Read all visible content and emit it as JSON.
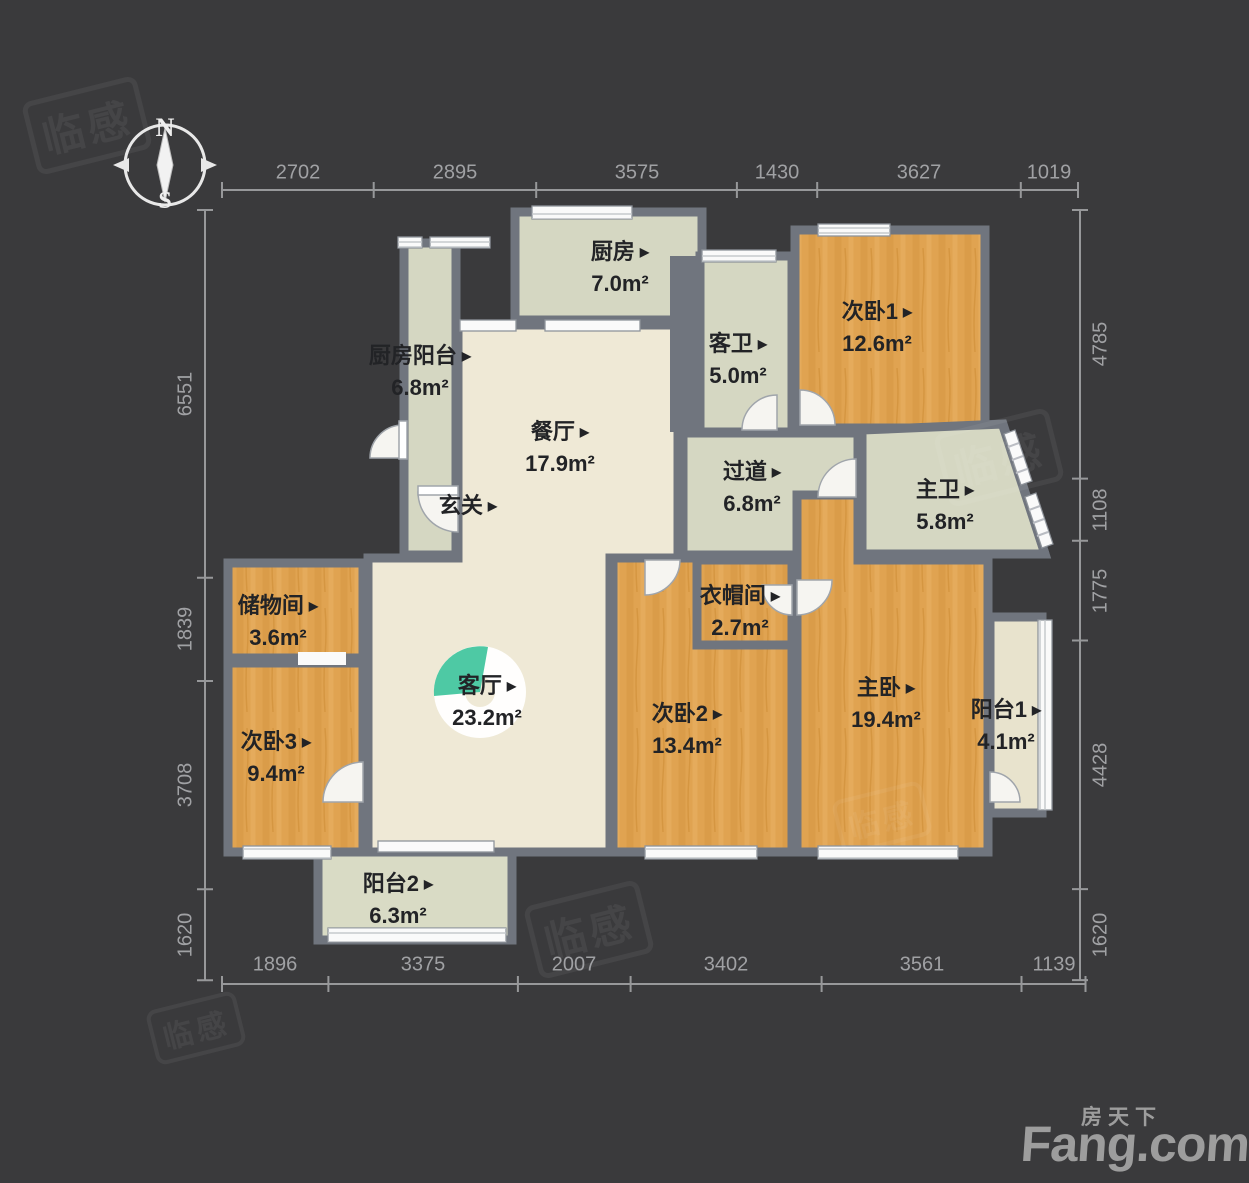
{
  "compass": {
    "north": "N",
    "south": "S"
  },
  "icons": {
    "room_arrow": "▶"
  },
  "rooms": [
    {
      "id": "kitchen",
      "name": "厨房",
      "area": "7.0m²"
    },
    {
      "id": "kitchen-balcony",
      "name": "厨房阳台",
      "area": "6.8m²"
    },
    {
      "id": "guest-bathroom",
      "name": "客卫",
      "area": "5.0m²"
    },
    {
      "id": "bedroom-1",
      "name": "次卧1",
      "area": "12.6m²"
    },
    {
      "id": "dining-room",
      "name": "餐厅",
      "area": "17.9m²"
    },
    {
      "id": "entryway",
      "name": "玄关",
      "area": ""
    },
    {
      "id": "hallway",
      "name": "过道",
      "area": "6.8m²"
    },
    {
      "id": "master-bathroom",
      "name": "主卫",
      "area": "5.8m²"
    },
    {
      "id": "storage-room",
      "name": "储物间",
      "area": "3.6m²"
    },
    {
      "id": "cloakroom",
      "name": "衣帽间",
      "area": "2.7m²"
    },
    {
      "id": "living-room",
      "name": "客厅",
      "area": "23.2m²"
    },
    {
      "id": "bedroom-2",
      "name": "次卧2",
      "area": "13.4m²"
    },
    {
      "id": "master-bedroom",
      "name": "主卧",
      "area": "19.4m²"
    },
    {
      "id": "balcony-1",
      "name": "阳台1",
      "area": "4.1m²"
    },
    {
      "id": "bedroom-3",
      "name": "次卧3",
      "area": "9.4m²"
    },
    {
      "id": "balcony-2",
      "name": "阳台2",
      "area": "6.3m²"
    }
  ],
  "dimensions": {
    "top": [
      "2702",
      "2895",
      "3575",
      "1430",
      "3627",
      "1019"
    ],
    "bottom": [
      "1896",
      "3375",
      "2007",
      "3402",
      "3561",
      "1139"
    ],
    "left": [
      "6551",
      "1839",
      "3708",
      "1620"
    ],
    "right": [
      "4785",
      "1108",
      "1775",
      "4428",
      "1620"
    ]
  },
  "watermark": {
    "text": "临感"
  },
  "branding": {
    "site_cn": "房天下",
    "site_en": "Fang.com"
  },
  "colors": {
    "background": "#3a3a3c",
    "wall": "#70757e",
    "floor_cream": "#efe9d6",
    "floor_sage": "#d5d7c2",
    "floor_wood": "#e0a351",
    "accent_teal": "#4ec9a4",
    "dim_text": "#a0a1a4",
    "logo_gray": "#9d9d9d"
  }
}
